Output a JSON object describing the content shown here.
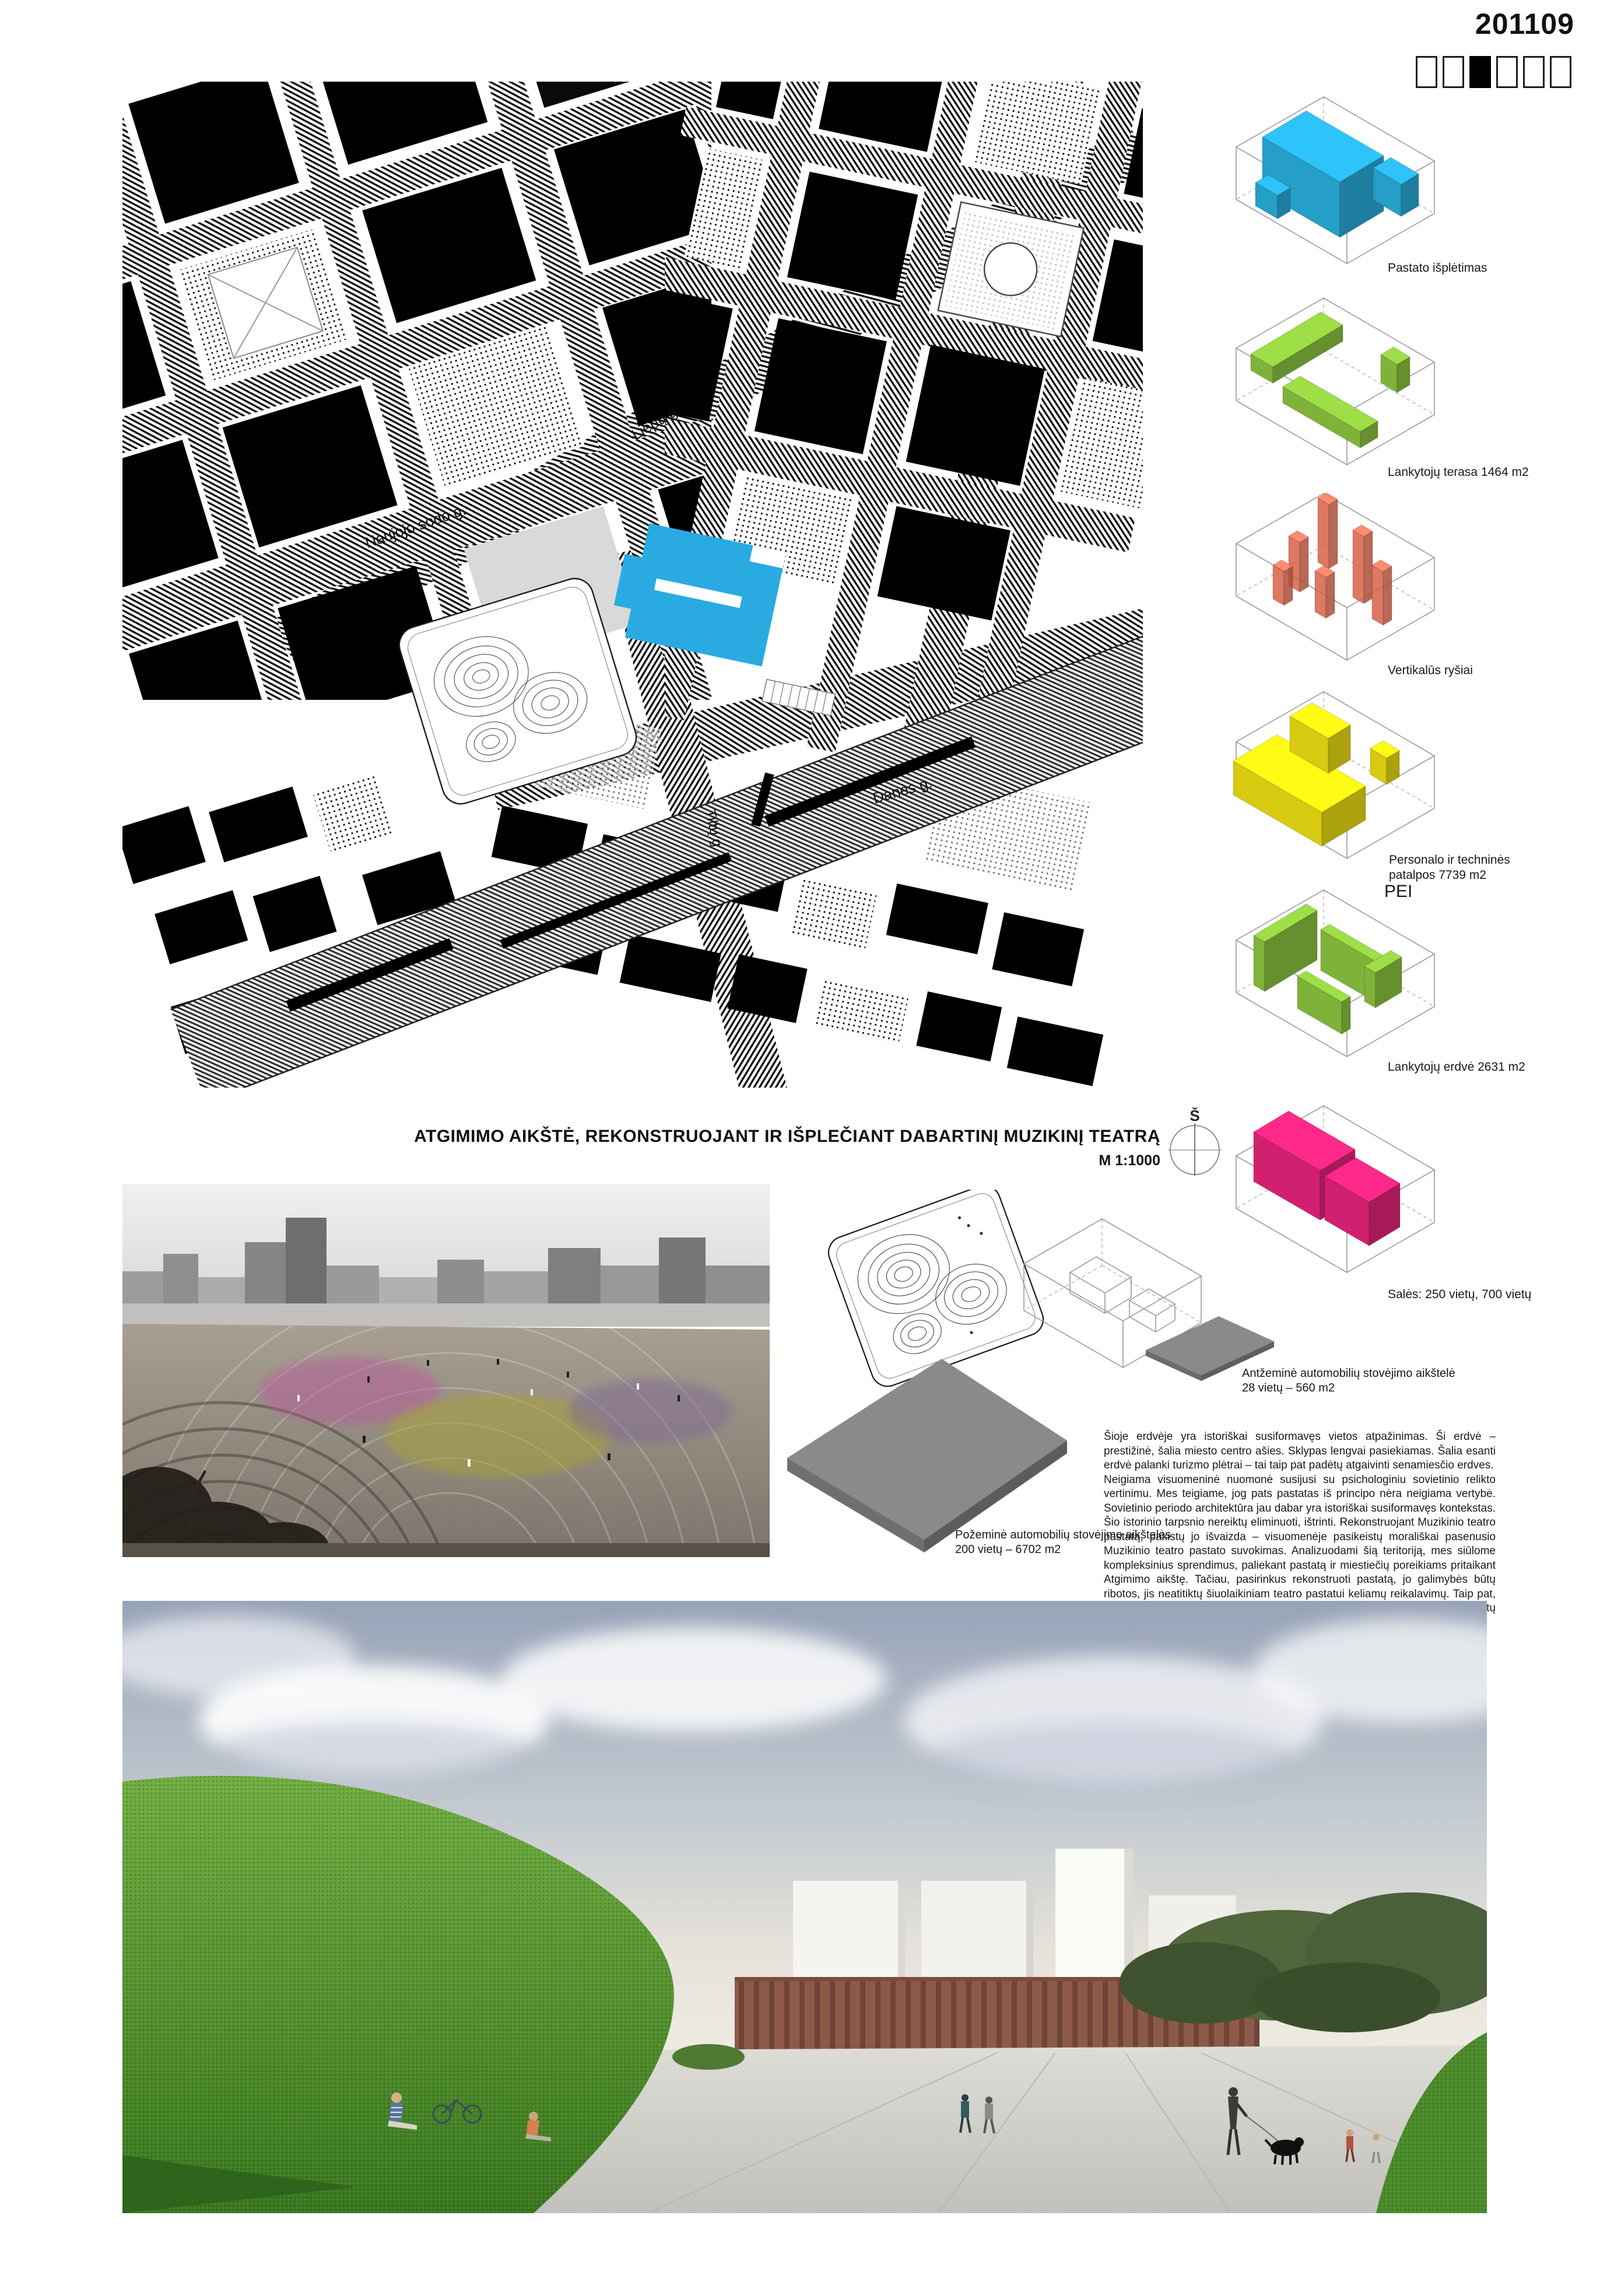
{
  "header": {
    "board_number": "201109",
    "page_count": 6,
    "active_page": 3
  },
  "colors": {
    "map_highlight": "#29ABE2",
    "plate_gray": "#8A8A8A"
  },
  "map": {
    "streets": {
      "naujojo": "Naujojo sodo g.",
      "liepu": "Liepų g.",
      "danes": "Danės g.",
      "tiltu": "Tiltų g."
    }
  },
  "diagrams": [
    {
      "label": "Pastato išplėtimas",
      "color": "#29AFDE"
    },
    {
      "label": "Lankytojų terasa 1464 m2",
      "color": "#8DC63F"
    },
    {
      "label": "Vertikalūs ryšiai",
      "color": "#EF6B4F"
    },
    {
      "label_line1": "Personalo ir techninės",
      "label_line2": "patalpos 7739 m2",
      "label_sub": "PEI",
      "color": "#EFE013"
    },
    {
      "label": "Lankytojų erdvė 2631 m2",
      "color": "#8DC63F"
    },
    {
      "label": "Salės: 250 vietų, 700 vietų",
      "color": "#E8247C"
    }
  ],
  "title": {
    "main": "ATGIMIMO AIKŠTĖ, REKONSTRUOJANT IR IŠPLEČIANT DABARTINĮ MUZIKINĮ TEATRĄ",
    "scale": "M 1:1000",
    "north": "Š"
  },
  "parking": {
    "surface_line1": "Antžeminė automobilių stovėjimo aikštelė",
    "surface_line2": "28 vietų – 560 m2",
    "underground_line1": "Požeminė automobilių stovėjimo aikštelės",
    "underground_line2": "200 vietų – 6702 m2"
  },
  "description": {
    "p1": "Šioje erdvėje yra istoriškai susiformavęs vietos atpažinimas. Ši erdvė – prestižinė, šalia miesto centro ašies. Sklypas lengvai pasiekiamas. Šalia esanti erdvė palanki turizmo plėtrai – tai taip pat padėtų atgaivinti senamiesčio erdves.",
    "p2": "Neigiama visuomeninė nuomonė susijusi su psichologiniu sovietinio relikto vertinimu. Mes teigiame, jog pats pastatas iš principo nėra neigiama vertybė. Sovietinio periodo architektūra jau dabar yra istoriškai susiformavęs kontekstas. Šio istorinio tarpsnio nereiktų eliminuoti, ištrinti. Rekonstruojant Muzikinio teatro pastatą, pakistų jo išvaizda – visuomenėje pasikeistų morališkai pasenusio Muzikinio teatro pastato suvokimas. Analizuodami šią teritoriją, mes siūlome kompleksinius sprendimus, paliekant pastatą ir miestiečių poreikiams pritaikant Atgimimo aikštę. Tačiau, pasirinkus rekonstruoti pastatą, jo galimybės būtų ribotos, jis neatitiktų šiuolaikiniam teatro pastatui keliamų reikalavimų. Taip pat, kol vyktų rekonstrukcijos darbai, Muzikinio teatro personalas bei grupės turėtų ieškotis laikinos erdvės."
  }
}
